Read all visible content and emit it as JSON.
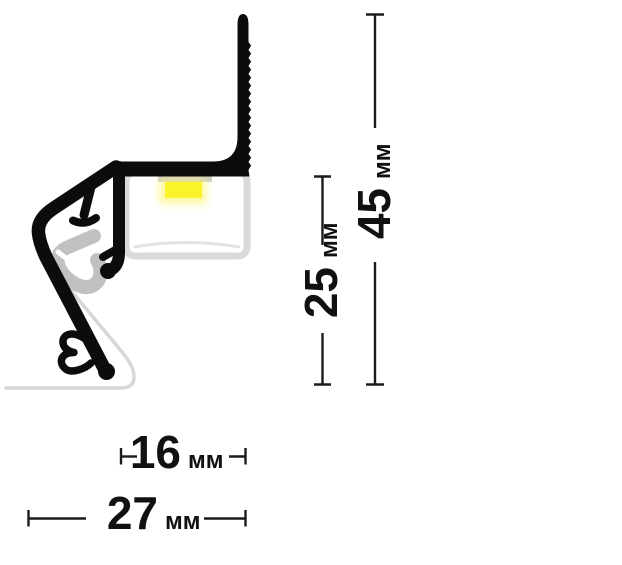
{
  "diagram": {
    "kind": "profile-cross-section-drawing",
    "dimensions": {
      "overall_height": {
        "value": "45",
        "unit": "мм"
      },
      "inner_height": {
        "value": "25",
        "unit": "мм"
      },
      "inner_width": {
        "value": "16",
        "unit": "мм"
      },
      "overall_width": {
        "value": "27",
        "unit": "мм"
      }
    },
    "colors": {
      "profile_black": "#0c0c0c",
      "led_yellow": "#fbf32b",
      "led_bar_gray": "#cfcfcf",
      "diffuser_border_gray": "#dadada",
      "clip_gray": "#c1c1c1",
      "skirt_gray": "#d7d7d7",
      "dimension_line": "#1b1b1b",
      "background": "#ffffff"
    }
  }
}
